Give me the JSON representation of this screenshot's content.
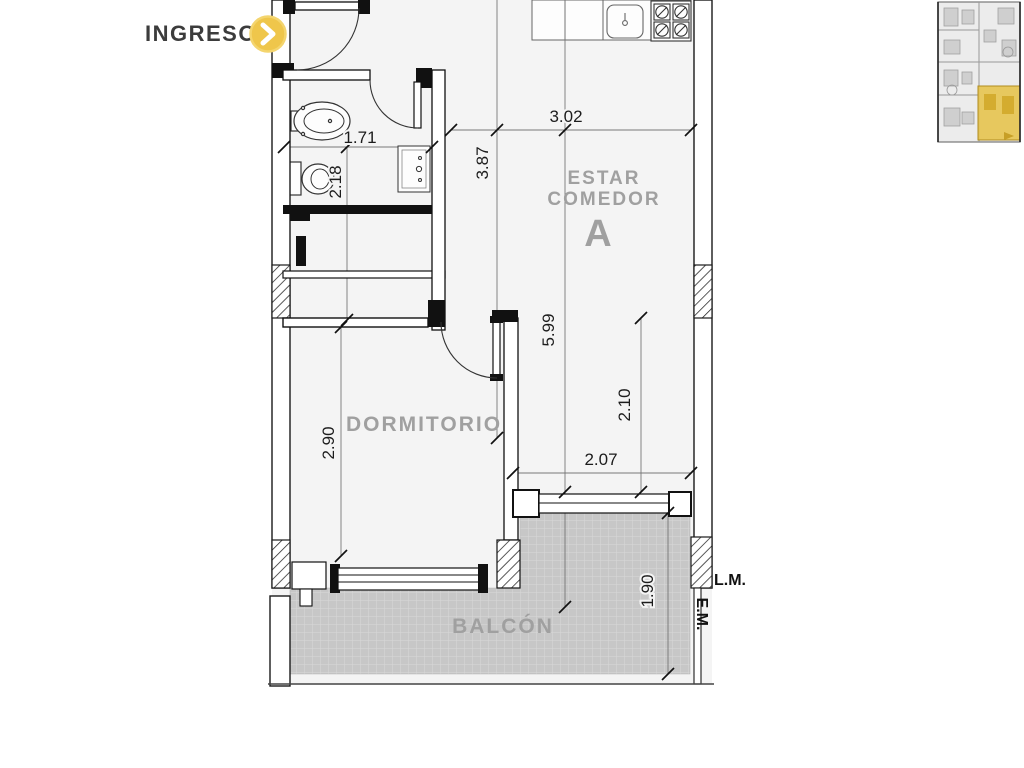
{
  "ingreso": {
    "label": "INGRESO"
  },
  "rooms": {
    "estar_line1": "ESTAR",
    "estar_line2": "COMEDOR",
    "unit_letter": "A",
    "dormitorio": "DORMITORIO",
    "balcon": "BALCÓN"
  },
  "dims": {
    "bath_width": "1.71",
    "bath_depth": "2.18",
    "kitchen_width": "3.02",
    "living_depth": "3.87",
    "unit_depth": "5.99",
    "living_width": "2.10",
    "balcony_door_width": "2.07",
    "bedroom_width": "2.90",
    "balcony_depth": "1.90"
  },
  "boundaries": {
    "lm": "L.M.",
    "em": "E.M."
  },
  "colors": {
    "accent_yellow": "#EFC64B",
    "room_label_gray": "#A0A0A0",
    "wall_line": "#1A1A1A",
    "floor_fill": "#F4F4F4",
    "balcony_tile": "#C7C7C7",
    "ingreso_text": "#3C3C3C"
  }
}
